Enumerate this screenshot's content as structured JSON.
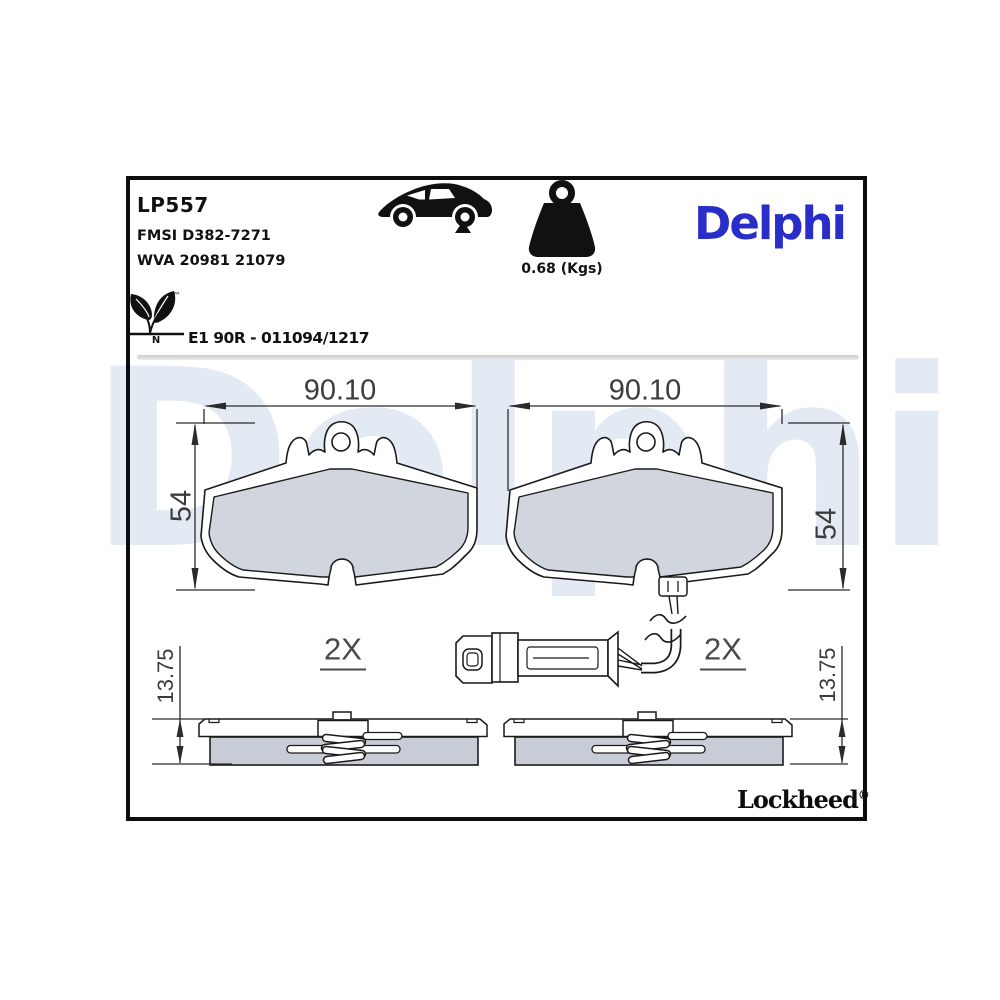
{
  "header": {
    "part_number": "LP557",
    "fmsi_ref": "FMSI D382-7271",
    "wva_ref": "WVA 20981 21079",
    "weight_label": "0.68 (Kgs)",
    "approval_code": "E1 90R - 011094/1217",
    "eco_letter": "N",
    "trademark_symbol": "™"
  },
  "brand": {
    "logo_text": "Delphi",
    "logo_color": "#2a2ec8",
    "watermark_text": "Delphi",
    "footer_brand": "Lockheed",
    "registered_symbol": "®"
  },
  "dimensions": {
    "width_label": "90.10",
    "height_label": "54",
    "thickness_label": "13.75",
    "quantity_label": "2X"
  },
  "icons": {
    "car": "car-side-icon",
    "weight": "kettlebell-weight-icon",
    "eco": "eco-leaf-icon"
  },
  "colors": {
    "friction_gray": "#c7ccd6",
    "outline_black": "#1a1a1a",
    "watermark_blue": "#e4eaf4",
    "dimension_gray": "#3c3c3c"
  }
}
